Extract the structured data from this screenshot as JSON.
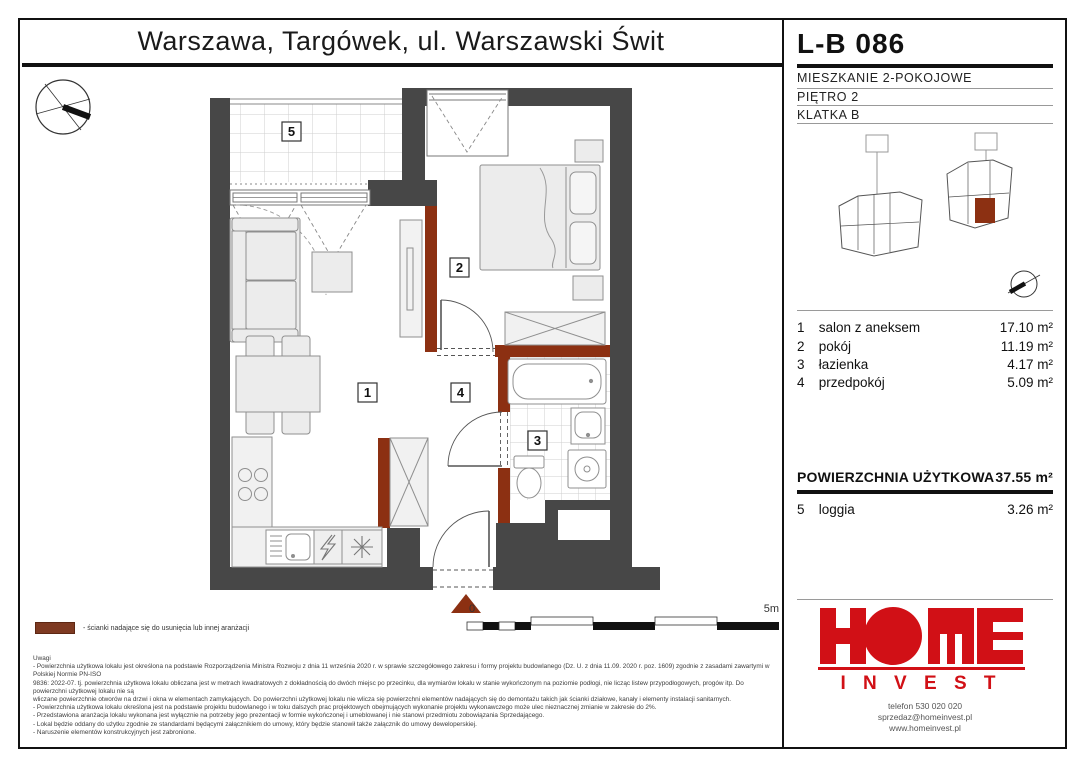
{
  "page": {
    "title": "Warszawa, Targówek, ul. Warszawski Świt"
  },
  "unit": {
    "id": "L-B 086",
    "type": "MIESZKANIE 2-POKOJOWE",
    "floor": "PIĘTRO 2",
    "staircase": "KLATKA B"
  },
  "buildings": {
    "a_label": "A",
    "b_label": "B"
  },
  "rooms": [
    {
      "num": "1",
      "name": "salon z aneksem",
      "area": "17.10 m²"
    },
    {
      "num": "2",
      "name": "pokój",
      "area": "11.19 m²"
    },
    {
      "num": "3",
      "name": "łazienka",
      "area": "4.17 m²"
    },
    {
      "num": "4",
      "name": "przedpokój",
      "area": "5.09 m²"
    }
  ],
  "total": {
    "label": "POWIERZCHNIA UŻYTKOWA",
    "value": "37.55 m²"
  },
  "extra_room": {
    "num": "5",
    "name": "loggia",
    "area": "3.26 m²"
  },
  "plan_labels": [
    "1",
    "2",
    "3",
    "4",
    "5"
  ],
  "scale": {
    "start": "0",
    "end": "5m"
  },
  "legend": {
    "text": "- ścianki nadające się do usunięcia lub innej aranżacji"
  },
  "notes": {
    "title": "Uwagi",
    "lines": [
      "- Powierzchnia użytkowa lokalu jest określona na podstawie Rozporządzenia Ministra Rozwoju z dnia 11 września 2020 r. w sprawie szczegółowego zakresu i formy projektu budowlanego (Dz. U. z dnia 11.09. 2020 r. poz. 1609) zgodnie z zasadami zawartymi w Polskiej Normie PN-ISO",
      "9836: 2022-07. tj. powierzchnia użytkowa lokalu obliczana jest w metrach kwadratowych z dokładnością do dwóch miejsc po przecinku, dla wymiarów lokalu w stanie wykończonym na poziomie podłogi, nie licząc listew przypodłogowych, progów itp. Do powierzchni użytkowej lokalu nie są",
      "wliczane powierzchnie otworów na drzwi i okna w elementach zamykających. Do powierzchni użytkowej lokalu nie wlicza się powierzchni elementów nadających się do demontażu takich jak ścianki działowe, kanały i elementy instalacji sanitarnych.",
      "- Powierzchnia użytkowa lokalu określona jest na podstawie projektu budowlanego i w toku dalszych prac projektowych obejmujących wykonanie projektu wykonawczego może ulec nieznacznej zmianie w zakresie do 2%.",
      "- Przedstawiona aranżacja lokalu wykonana jest wyłącznie na potrzeby jego prezentacji w formie wykończonej i umeblowanej i nie stanowi przedmiotu zobowiązania Sprzedającego.",
      "- Lokal będzie oddany do użytku zgodnie ze standardami będącymi załącznikiem do umowy, który będzie stanowił także załącznik do umowy deweloperskiej.",
      "- Naruszenie elementów konstrukcyjnych jest zabronione."
    ]
  },
  "logo": {
    "invest": "I N V E S T",
    "phone": "telefon 530 020 020",
    "email": "sprzedaz@homeinvest.pl",
    "web": "www.homeinvest.pl"
  },
  "colors": {
    "wall": "#474747",
    "removable": "#8C3012",
    "logo_red": "#D11016"
  }
}
